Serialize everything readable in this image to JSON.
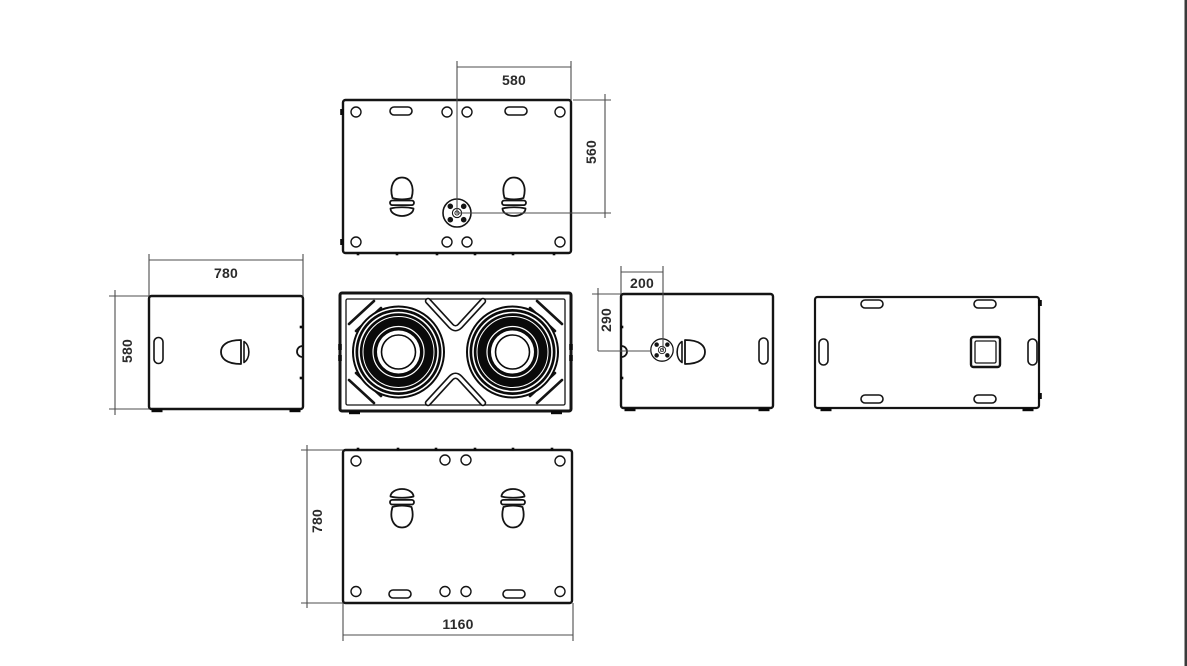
{
  "drawing": {
    "description": "Orthographic engineering views of a dual-woofer loudspeaker cabinet",
    "colors": {
      "line": "#141414",
      "dim_line": "#4d4d4d",
      "text": "#2b2b2b",
      "background": "#ffffff",
      "right_border": "#3a3a3a"
    },
    "dimensions": {
      "top_view": {
        "horizontal": "580",
        "vertical": "560"
      },
      "left_side_view": {
        "horizontal": "780",
        "vertical": "580"
      },
      "right_side_view": {
        "horizontal": "200",
        "vertical": "290"
      },
      "bottom_view": {
        "vertical": "780",
        "horizontal": "1160"
      }
    }
  }
}
